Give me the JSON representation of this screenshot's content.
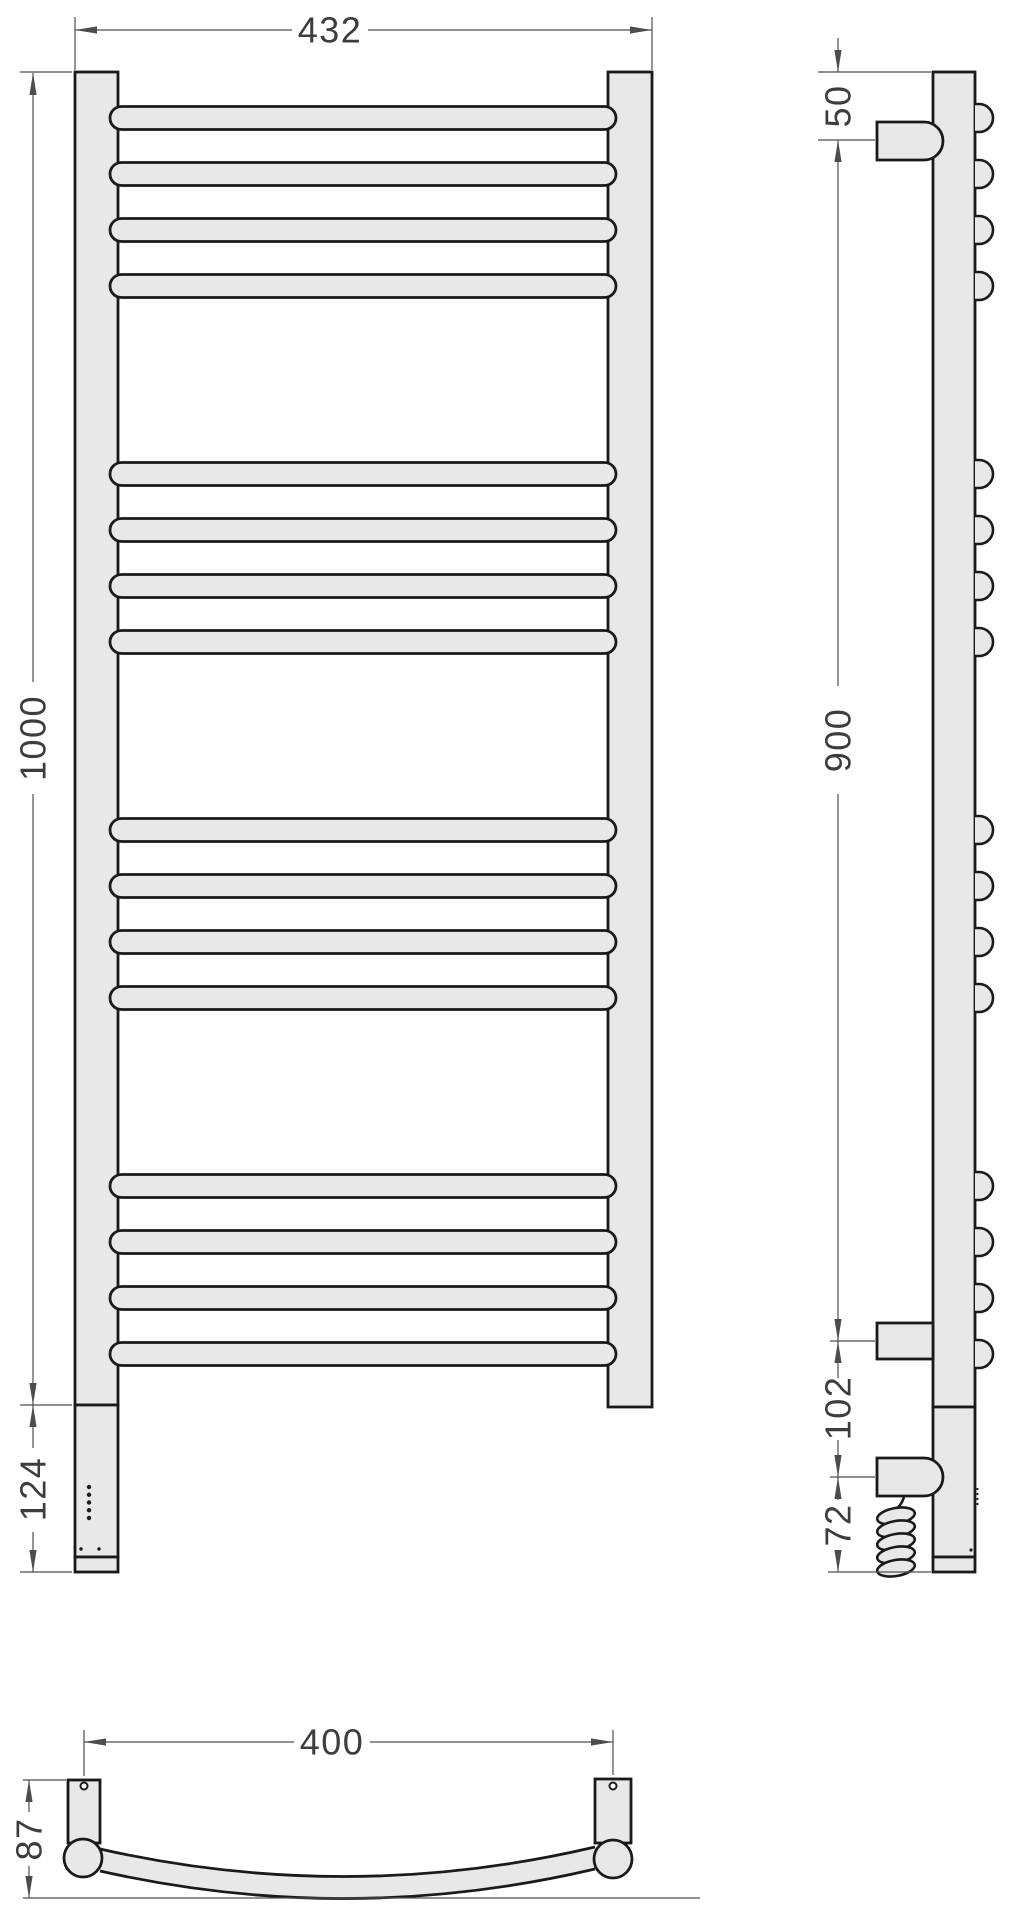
{
  "drawing": {
    "type": "technical-drawing",
    "subject": "ladder-style heated towel rail — front, side and bottom orthographic views",
    "units": "mm",
    "colors": {
      "background": "#ffffff",
      "part_fill": "#e8e8e8",
      "part_outline": "#1a1a1a",
      "dimension_line": "#4d4d4d",
      "dimension_text": "#3d3d3d"
    },
    "dimensions": {
      "width_overall": "432",
      "height_overall": "1000",
      "control_section_height": "124",
      "top_element_offset": "50",
      "mount_span": "900",
      "element_spacing": "102",
      "cable_drop": "72",
      "mount_width": "400",
      "depth": "87"
    },
    "geometry": {
      "rung_count": 16,
      "rung_groups": 4,
      "rungs_per_group": 4,
      "rung_centers_y": [
        118,
        174,
        230,
        286,
        474,
        530,
        586,
        642,
        830,
        886,
        942,
        998,
        1186,
        1242,
        1298,
        1354
      ],
      "led_dot_count": 5,
      "mount_hole_count": 2,
      "cable_coil_turns": 5
    }
  }
}
